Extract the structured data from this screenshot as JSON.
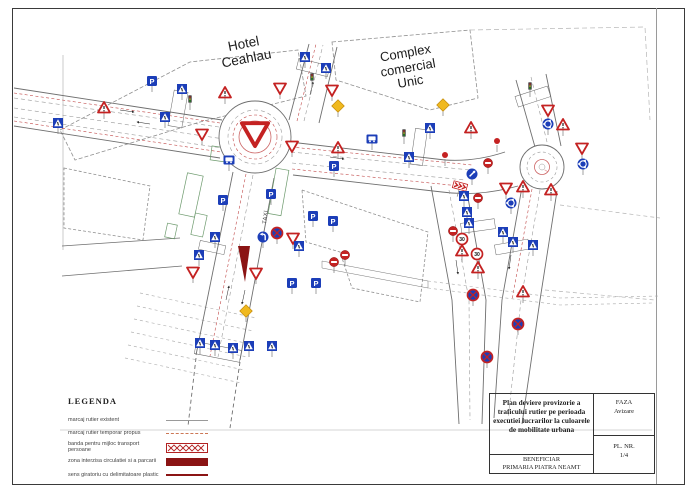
{
  "map": {
    "labels": {
      "hotel_line1": "Hotel",
      "hotel_line2": "Ceahlau",
      "complex_line1": "Complex",
      "complex_line2": "comercial",
      "complex_line3": "Unic",
      "taxi": "TAXI"
    },
    "signs": [
      {
        "t": "cross",
        "x": 58,
        "y": 123
      },
      {
        "t": "warn",
        "x": 104,
        "y": 108
      },
      {
        "t": "P",
        "x": 152,
        "y": 81
      },
      {
        "t": "cross",
        "x": 182,
        "y": 89
      },
      {
        "t": "cross",
        "x": 165,
        "y": 117
      },
      {
        "t": "yield",
        "x": 202,
        "y": 134
      },
      {
        "t": "warn",
        "x": 225,
        "y": 93
      },
      {
        "t": "cross",
        "x": 305,
        "y": 57
      },
      {
        "t": "cross",
        "x": 326,
        "y": 68
      },
      {
        "t": "yield",
        "x": 280,
        "y": 88
      },
      {
        "t": "yield",
        "x": 332,
        "y": 90
      },
      {
        "t": "diamond",
        "x": 338,
        "y": 106
      },
      {
        "t": "diamond",
        "x": 443,
        "y": 105
      },
      {
        "t": "bus",
        "x": 229,
        "y": 160
      },
      {
        "t": "yield",
        "x": 292,
        "y": 146
      },
      {
        "t": "warn",
        "x": 338,
        "y": 148
      },
      {
        "t": "P",
        "x": 223,
        "y": 200
      },
      {
        "t": "P",
        "x": 271,
        "y": 194
      },
      {
        "t": "P",
        "x": 334,
        "y": 166
      },
      {
        "t": "bus",
        "x": 372,
        "y": 139
      },
      {
        "t": "cross",
        "x": 409,
        "y": 157
      },
      {
        "t": "cross",
        "x": 430,
        "y": 128
      },
      {
        "t": "P",
        "x": 313,
        "y": 216
      },
      {
        "t": "P",
        "x": 333,
        "y": 221
      },
      {
        "t": "yield",
        "x": 255,
        "y": 133,
        "s": 24,
        "np": 1
      },
      {
        "t": "cross",
        "x": 215,
        "y": 237
      },
      {
        "t": "turnL",
        "x": 263,
        "y": 237
      },
      {
        "t": "nostop",
        "x": 277,
        "y": 233
      },
      {
        "t": "yield",
        "x": 293,
        "y": 238
      },
      {
        "t": "cross",
        "x": 299,
        "y": 246
      },
      {
        "t": "cross",
        "x": 199,
        "y": 255
      },
      {
        "t": "yield",
        "x": 193,
        "y": 272
      },
      {
        "t": "yield",
        "x": 256,
        "y": 273
      },
      {
        "t": "noent",
        "x": 334,
        "y": 262
      },
      {
        "t": "noent",
        "x": 345,
        "y": 255
      },
      {
        "t": "P",
        "x": 292,
        "y": 283
      },
      {
        "t": "P",
        "x": 316,
        "y": 283
      },
      {
        "t": "diamond",
        "x": 246,
        "y": 311
      },
      {
        "t": "cross",
        "x": 200,
        "y": 343
      },
      {
        "t": "cross",
        "x": 215,
        "y": 345
      },
      {
        "t": "cross",
        "x": 233,
        "y": 348
      },
      {
        "t": "cross",
        "x": 249,
        "y": 346
      },
      {
        "t": "cross",
        "x": 272,
        "y": 346
      },
      {
        "t": "keepR",
        "x": 472,
        "y": 174
      },
      {
        "t": "chev",
        "x": 460,
        "y": 186,
        "r": 15
      },
      {
        "t": "reddot",
        "x": 497,
        "y": 141
      },
      {
        "t": "noent",
        "x": 488,
        "y": 163
      },
      {
        "t": "warn",
        "x": 471,
        "y": 128
      },
      {
        "t": "reddot",
        "x": 445,
        "y": 155
      },
      {
        "t": "cross",
        "x": 464,
        "y": 196
      },
      {
        "t": "noent",
        "x": 478,
        "y": 198
      },
      {
        "t": "cross",
        "x": 467,
        "y": 212
      },
      {
        "t": "noent",
        "x": 453,
        "y": 231
      },
      {
        "t": "cross",
        "x": 469,
        "y": 223
      },
      {
        "t": "s30",
        "x": 462,
        "y": 239
      },
      {
        "t": "warn",
        "x": 462,
        "y": 251
      },
      {
        "t": "s30",
        "x": 477,
        "y": 254
      },
      {
        "t": "warn",
        "x": 478,
        "y": 268
      },
      {
        "t": "nostop",
        "x": 473,
        "y": 295
      },
      {
        "t": "warn",
        "x": 523,
        "y": 292
      },
      {
        "t": "nostop",
        "x": 518,
        "y": 324
      },
      {
        "t": "nostop",
        "x": 487,
        "y": 357
      },
      {
        "t": "cross",
        "x": 503,
        "y": 232
      },
      {
        "t": "cross",
        "x": 513,
        "y": 242
      },
      {
        "t": "cross",
        "x": 533,
        "y": 245
      },
      {
        "t": "yield",
        "x": 548,
        "y": 110
      },
      {
        "t": "rbt",
        "x": 548,
        "y": 124
      },
      {
        "t": "warn",
        "x": 563,
        "y": 125
      },
      {
        "t": "yield",
        "x": 582,
        "y": 148
      },
      {
        "t": "rbt",
        "x": 583,
        "y": 164
      },
      {
        "t": "yield",
        "x": 506,
        "y": 188
      },
      {
        "t": "warn",
        "x": 523,
        "y": 187
      },
      {
        "t": "rbt",
        "x": 511,
        "y": 203
      },
      {
        "t": "warn",
        "x": 551,
        "y": 190
      },
      {
        "t": "tl",
        "x": 190,
        "y": 99
      },
      {
        "t": "tl",
        "x": 312,
        "y": 77
      },
      {
        "t": "tl",
        "x": 404,
        "y": 133
      },
      {
        "t": "tl",
        "x": 530,
        "y": 86
      }
    ]
  },
  "legend": {
    "title": "LEGENDA",
    "items": [
      {
        "label": "marcaj rutier existent",
        "swatch": "existing-marking"
      },
      {
        "label": "marcaj rutier temporar propus",
        "swatch": "temporary-marking"
      },
      {
        "label": "banda pentru mijloc transport persoane",
        "swatch": "public-transport-lane"
      },
      {
        "label": "zona interzisa circulatiei si a parcarii",
        "swatch": "closed-zone"
      },
      {
        "label": "sens giratoriu cu delimitatoare plastic",
        "swatch": "giratory-plastic-delimiters"
      }
    ]
  },
  "title_block": {
    "title": "Plan deviere provizorie a traficului rutier pe perioada executiei lucrarilor la culoarele de mobilitate urbana",
    "faza_label": "FAZA",
    "faza_value": "Avizare",
    "pl_label": "PL. NR.",
    "pl_value": "1/4",
    "beneficiar_label": "BENEFICIAR",
    "beneficiar_value": "PRIMARIA PIATRA NEAMT"
  },
  "colors": {
    "sign_blue": "#1c3eb8",
    "sign_red": "#c42222",
    "yellow": "#f0b91f",
    "dark_red": "#8b1414",
    "road_line": "#6f6f6f",
    "red_marking": "#c04848",
    "green_area": "#85ae85"
  }
}
